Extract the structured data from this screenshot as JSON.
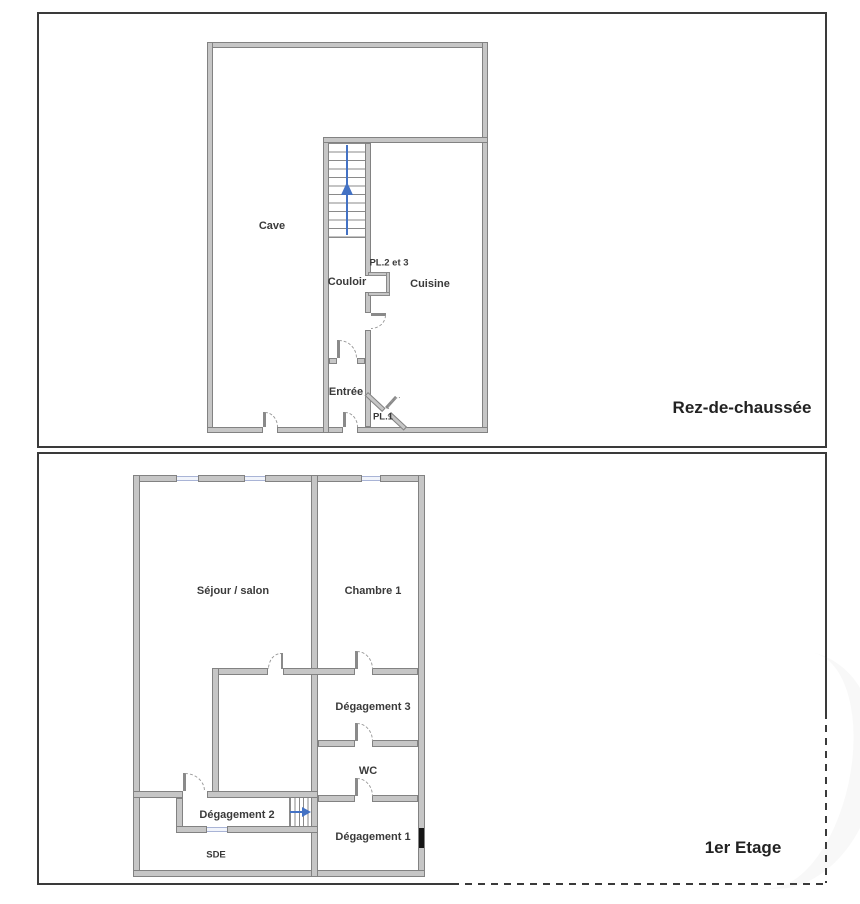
{
  "rdc": {
    "title": "Rez-de-chaussée",
    "rooms": {
      "cave": "Cave",
      "couloir": "Couloir",
      "pl23": "PL.2 et 3",
      "cuisine": "Cuisine",
      "entree": "Entrée",
      "pl1": "PL.1"
    }
  },
  "etage1": {
    "title": "1er Etage",
    "rooms": {
      "sejour": "Séjour / salon",
      "chambre1": "Chambre 1",
      "degagement3": "Dégagement 3",
      "wc": "WC",
      "degagement2": "Dégagement 2",
      "sde": "SDE",
      "degagement1": "Dégagement 1"
    }
  },
  "colors": {
    "wall_fill": "#c6c6c6",
    "wall_edge": "#828282",
    "stair_arrow_blue": "#4472c4",
    "window_blue": "#a9b4d6",
    "panel_border": "#3a3a3a",
    "label_text": "#3a3a3a"
  }
}
